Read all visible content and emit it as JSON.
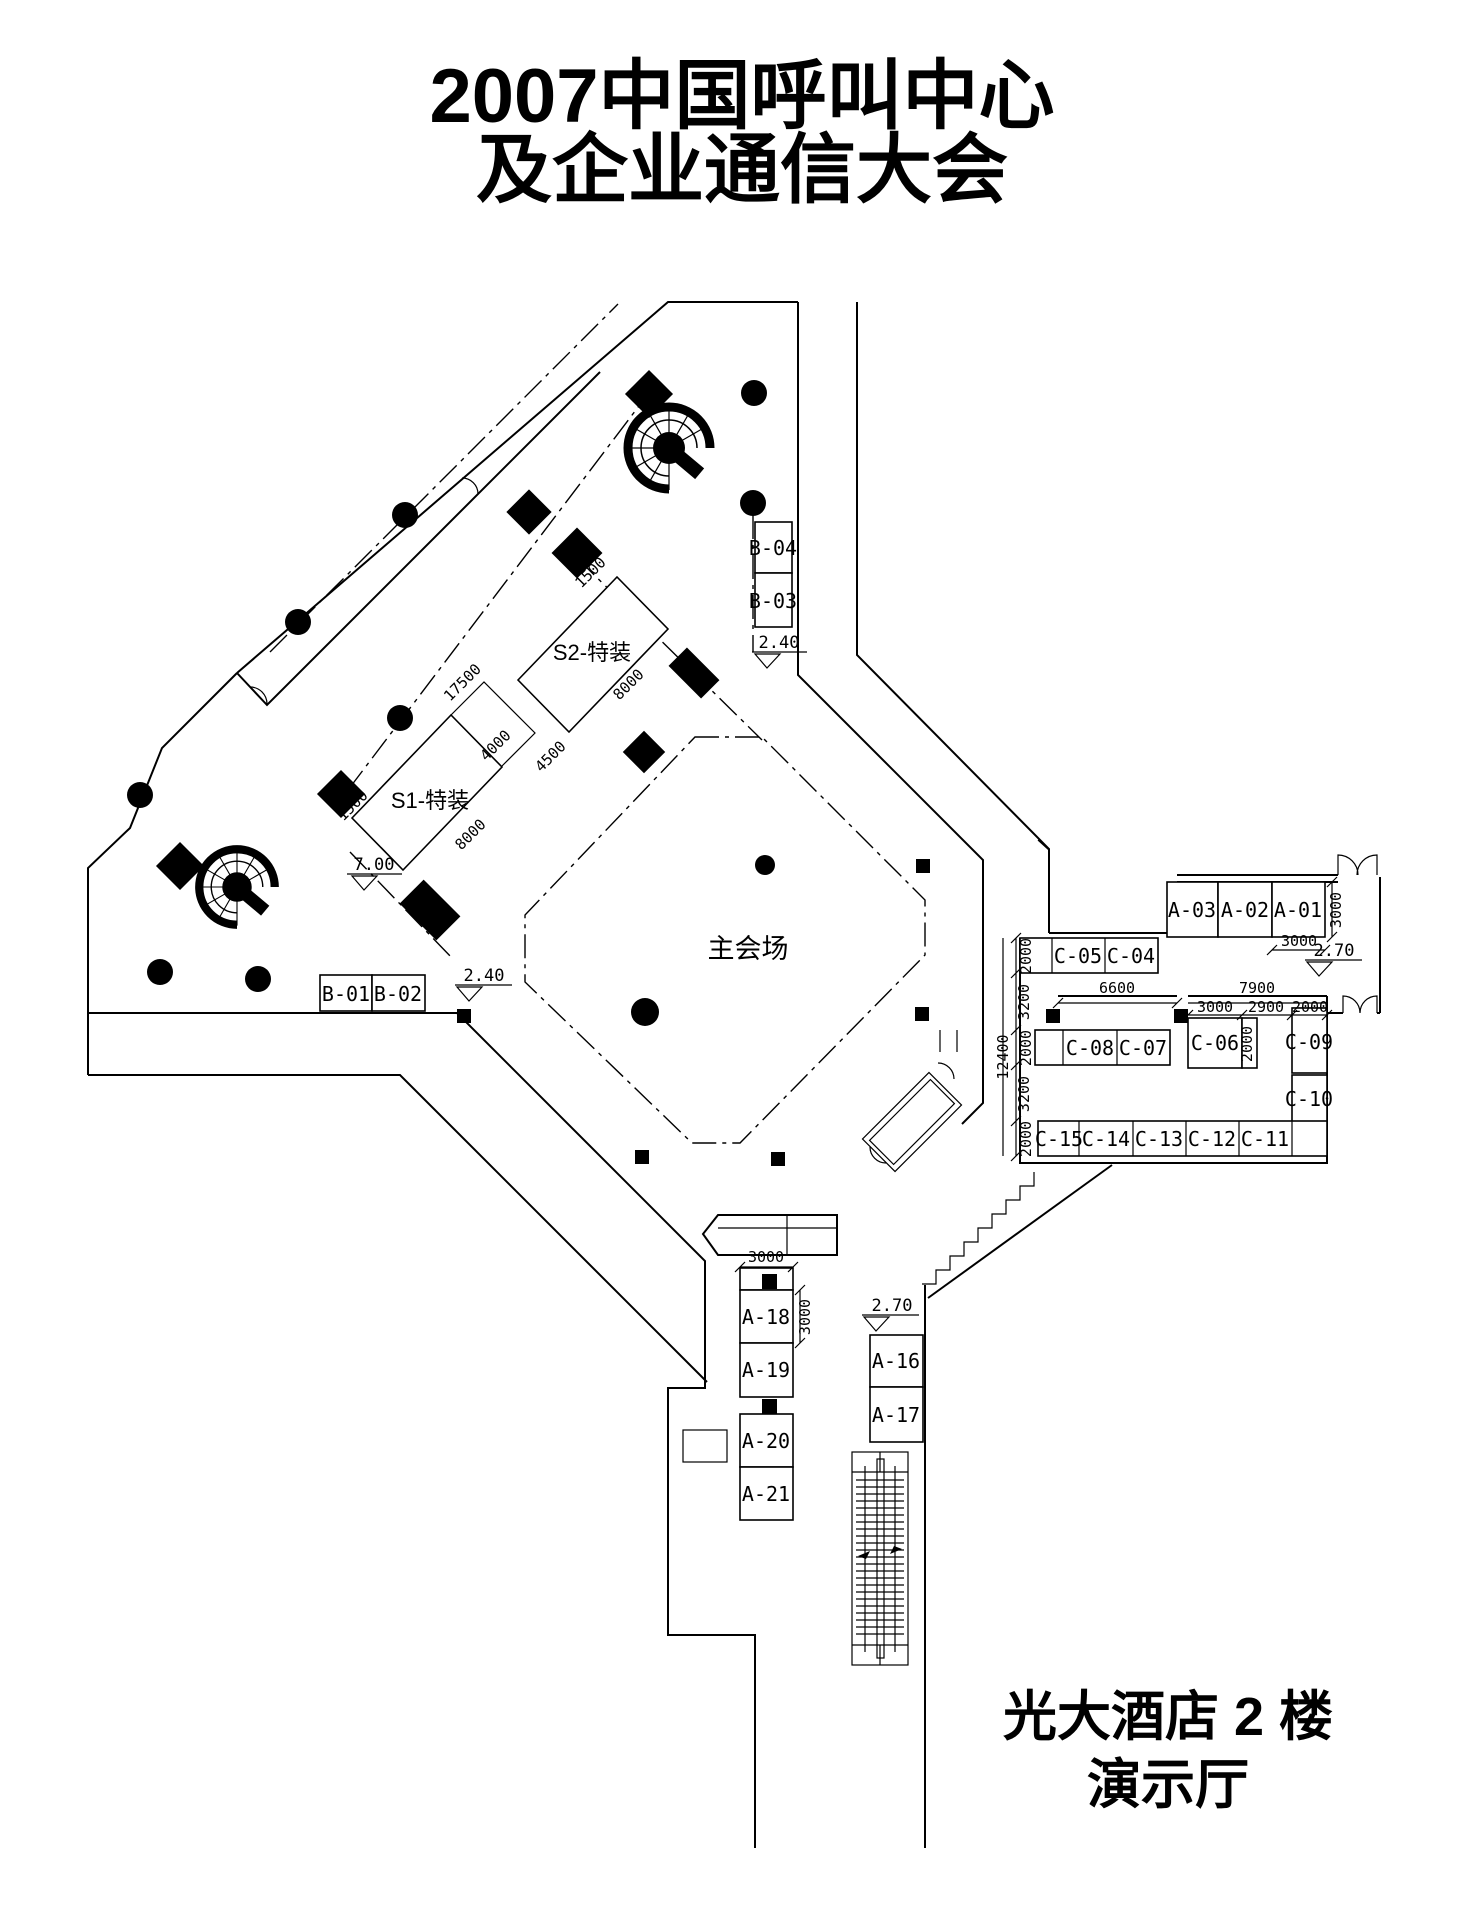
{
  "title": {
    "line1": "2007中国呼叫中心",
    "line2": "及企业通信大会"
  },
  "footer": {
    "line1": "光大酒店 2 楼",
    "line2": "演示厅"
  },
  "booths": {
    "b01": "B-01",
    "b02": "B-02",
    "b03": "B-03",
    "b04": "B-04",
    "s1": "S1-特装",
    "s2": "S2-特装",
    "hall": "主会场",
    "a01": "A-01",
    "a02": "A-02",
    "a03": "A-03",
    "a16": "A-16",
    "a17": "A-17",
    "a18": "A-18",
    "a19": "A-19",
    "a20": "A-20",
    "a21": "A-21",
    "c04": "C-04",
    "c05": "C-05",
    "c06": "C-06",
    "c07": "C-07",
    "c08": "C-08",
    "c09": "C-09",
    "c10": "C-10",
    "c11": "C-11",
    "c12": "C-12",
    "c13": "C-13",
    "c14": "C-14",
    "c15": "C-15"
  },
  "dimensions": {
    "wing_1500": "1500",
    "s1_1500": "1500",
    "band_17500": "17500",
    "band_4000": "4000",
    "band_4500": "4500",
    "s2_8000": "8000",
    "s1_8000": "8000",
    "a_row_width_3000": "3000",
    "a_row_depth_3000": "3000",
    "c_left_2000_a": "2000",
    "c_left_3200_a": "3200",
    "c_left_2000_b": "2000",
    "c_left_3200_b": "3200",
    "c_left_2000_c": "2000",
    "c_total_12400": "12400",
    "c_mid_6600": "6600",
    "c_right_7900": "7900",
    "c_sub_3000": "3000",
    "c_sub_2900": "2900",
    "c_sub_2000": "2000",
    "c06_2000": "2000",
    "a18_width_3000": "3000",
    "a18_depth_3000": "3000"
  },
  "levels": {
    "upper_700": "7.00",
    "b_240": "2.40",
    "hall_240": "2.40",
    "right_270": "2.70",
    "lower_270": "2.70"
  }
}
